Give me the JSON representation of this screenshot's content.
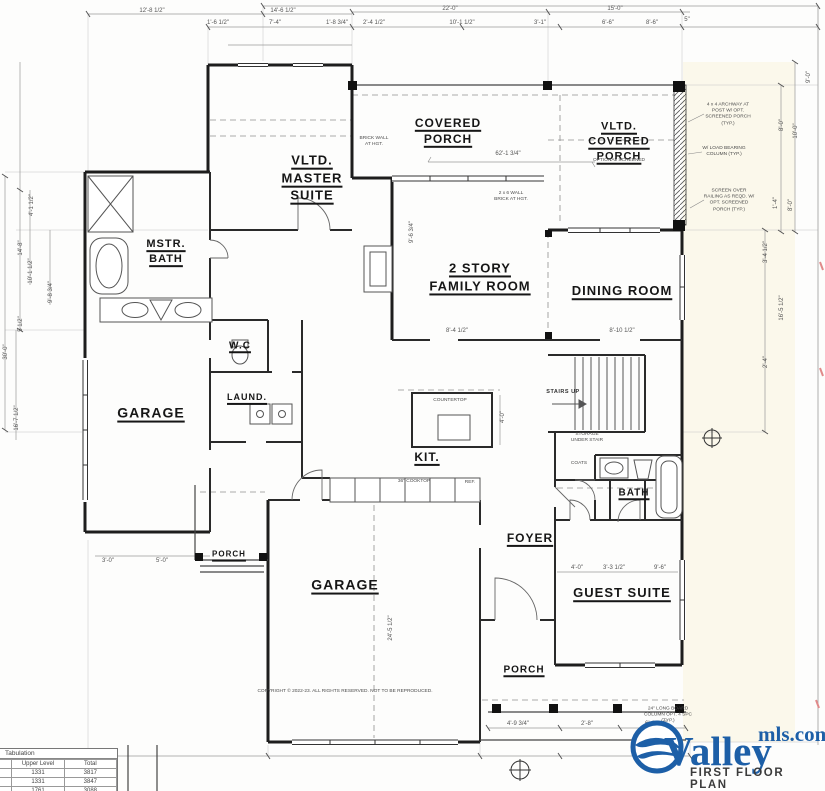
{
  "brand": {
    "name": "Valley",
    "suffix": "mls.com",
    "plan_title": "FIRST FLOOR PLAN"
  },
  "rooms": {
    "master_suite": {
      "l1": "VLTD.",
      "l2": "MASTER",
      "l3": "SUITE"
    },
    "covered_porch": {
      "l1": "COVERED",
      "l2": "PORCH"
    },
    "vltd_porch": {
      "l1": "VLTD.",
      "l2": "COVERED",
      "l3": "PORCH",
      "note": "OPTIONAL SCREENED"
    },
    "mstr_bath": {
      "l1": "MSTR.",
      "l2": "BATH"
    },
    "family_room": {
      "l1": "2 STORY",
      "l2": "FAMILY ROOM"
    },
    "dining_room": "DINING ROOM",
    "wc": "W.C",
    "garage_left": "GARAGE",
    "laundry": "LAUND.",
    "kitchen": "KIT.",
    "foyer": "FOYER",
    "bath": "BATH",
    "guest_suite": "GUEST SUITE",
    "garage_main": "GARAGE",
    "porch_left": "PORCH",
    "porch_rear": "PORCH"
  },
  "dims": {
    "top1": [
      "12'-8 1/2\"",
      "14'-6 1/2\"",
      "22'-0\"",
      "15'-0\""
    ],
    "top2": [
      "1'-6 1/2\"",
      "7'-4\"",
      "1'-8 3/4\"",
      "2'-4 1/2\"",
      "10'-1 1/2\"",
      "3'-1\"",
      "6'-6\"",
      "8'-6\"",
      "5\""
    ],
    "left": [
      "4'-1 1/2\"",
      "14'-8\"",
      "10'-1 1/2\"",
      "9'-8 3/4\"",
      "5 1/2\"",
      "30'-0\"",
      "16'-7 1/2\""
    ],
    "right": [
      "9'-0\"",
      "10'-0\"",
      "8'-0\"",
      "1'-4\"",
      "8'-0\"",
      "3'-4 1/2\"",
      "16'-5 1/2\"",
      "2'-4\""
    ],
    "inner": {
      "family": "8'-4 1/2\"",
      "dining": "8'-10 1/2\"",
      "porch_len": "62'-1 3/4\"",
      "family_h": "9'-6 3/4\"",
      "island": "4'-0\"",
      "garage_depth": "24'-5 1/2\"",
      "guest1": "4'-0\"",
      "guest2": "3'-3 1/2\"",
      "guest3": "9'-6\"",
      "porchl1": "3'-0\"",
      "porchl2": "5'-0\""
    },
    "bottom": [
      "4'-9 3/4\"",
      "2'-8\"",
      "6'-1 1/4\""
    ]
  },
  "annotations": {
    "brick_wall": "BRICK WALL AT HGT.",
    "wall26": "2 x 6 WALL BRICK AT HGT.",
    "archway": "4 x 4 ARCHWAY AT POST W/ OPT. SCREENED PORCH (TYP.)",
    "column": "W/ LOAD BEARING COLUMN (TYP.)",
    "screen": "SCREEN OVER RAILING AS REQD. W/ OPT. SCREENED PORCH (TYP.)",
    "stairs": "STAIRS UP",
    "storage": "STORAGE UNDER STAIR",
    "coats": "COATS",
    "countertop": "COUNTERTOP",
    "cooktop": "36\" COOKTOP",
    "ref": "REF.",
    "column2": "24\" LONG BOARD COLUMN OPT. 4 SPC (TYP.)",
    "copyright": "COPYRIGHT © 2022-23. ALL RIGHTS RESERVED. NOT TO BE REPRODUCED."
  },
  "table": {
    "title": "Tabulation",
    "col_upper": "Upper Level",
    "col_total": "Total",
    "rows": [
      [
        "1331",
        "3817"
      ],
      [
        "1331",
        "3847"
      ],
      [
        "1761",
        "3088"
      ]
    ]
  },
  "colors": {
    "brand_blue": "#1d5fa7",
    "line": "#222222",
    "dimline": "#999999"
  }
}
